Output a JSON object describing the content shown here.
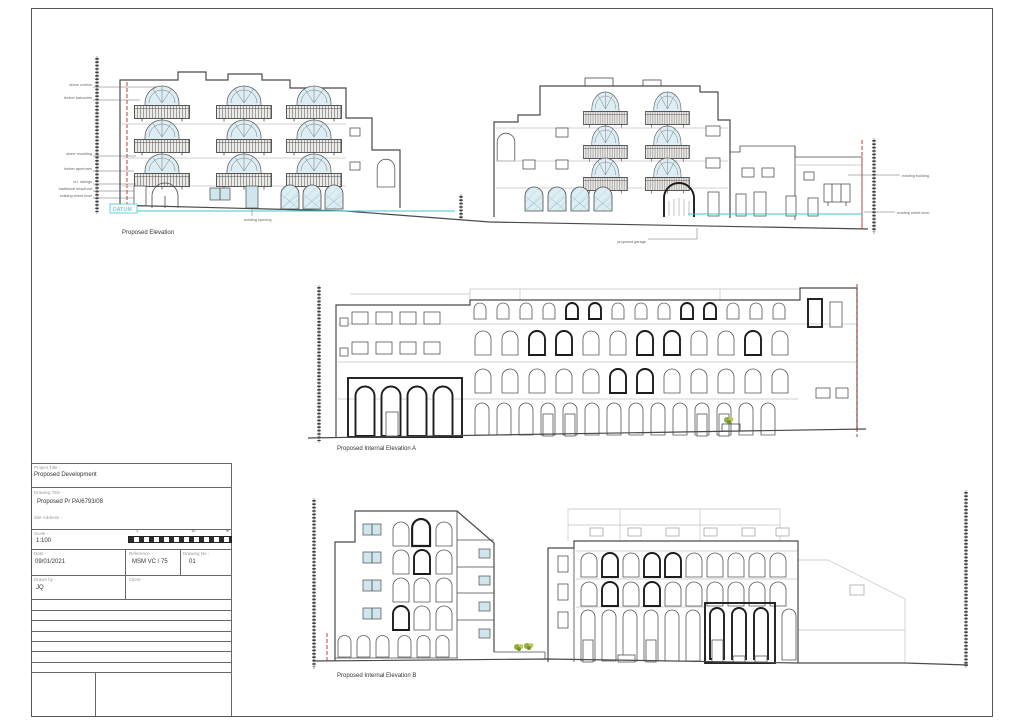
{
  "titleblock": {
    "project_label": "Project Title -",
    "project_value": "Proposed Development",
    "drawing_label": "Drawing Title -",
    "drawing_value": "Proposed Pr PA/6793/08",
    "site_label": "Site Address -",
    "scale_label": "Scale -",
    "scale_value": "1:100",
    "date_label": "Date -",
    "date_value": "09/01/2021",
    "reference_label": "Reference -",
    "reference_value": "MSM VC / 75",
    "drawing_no_label": "Drawing No -",
    "drawing_no_value": "01",
    "drawn_by_label": "Drawn by -",
    "drawn_by_value": "JQ",
    "client_label": "Client -",
    "scalebar": {
      "n1": "1",
      "n2": "10",
      "n3": "m"
    }
  },
  "drawings": {
    "proposed_elevation": {
      "label": "Proposed Elevation",
      "datum_label": "DATUM"
    },
    "internal_a": {
      "label": "Proposed Internal Elevation A"
    },
    "internal_b": {
      "label": "Proposed Internal Elevation B"
    }
  },
  "annotations": {
    "left": [
      "stone cornice",
      "timber balconies",
      "stone moulding",
      "timber apertures",
      "w.i. railings",
      "traditional shopfront",
      "existing street level"
    ],
    "right": [
      "existing building",
      "existing street level"
    ],
    "below_right": "proposed garage",
    "below_left": "existing opening"
  },
  "colors": {
    "datum": "#3fc6d6",
    "boundary": "#c43c3c",
    "glazing": "#d9edf4",
    "linework": "#4a4a4a",
    "faint": "#c2c2c2"
  }
}
